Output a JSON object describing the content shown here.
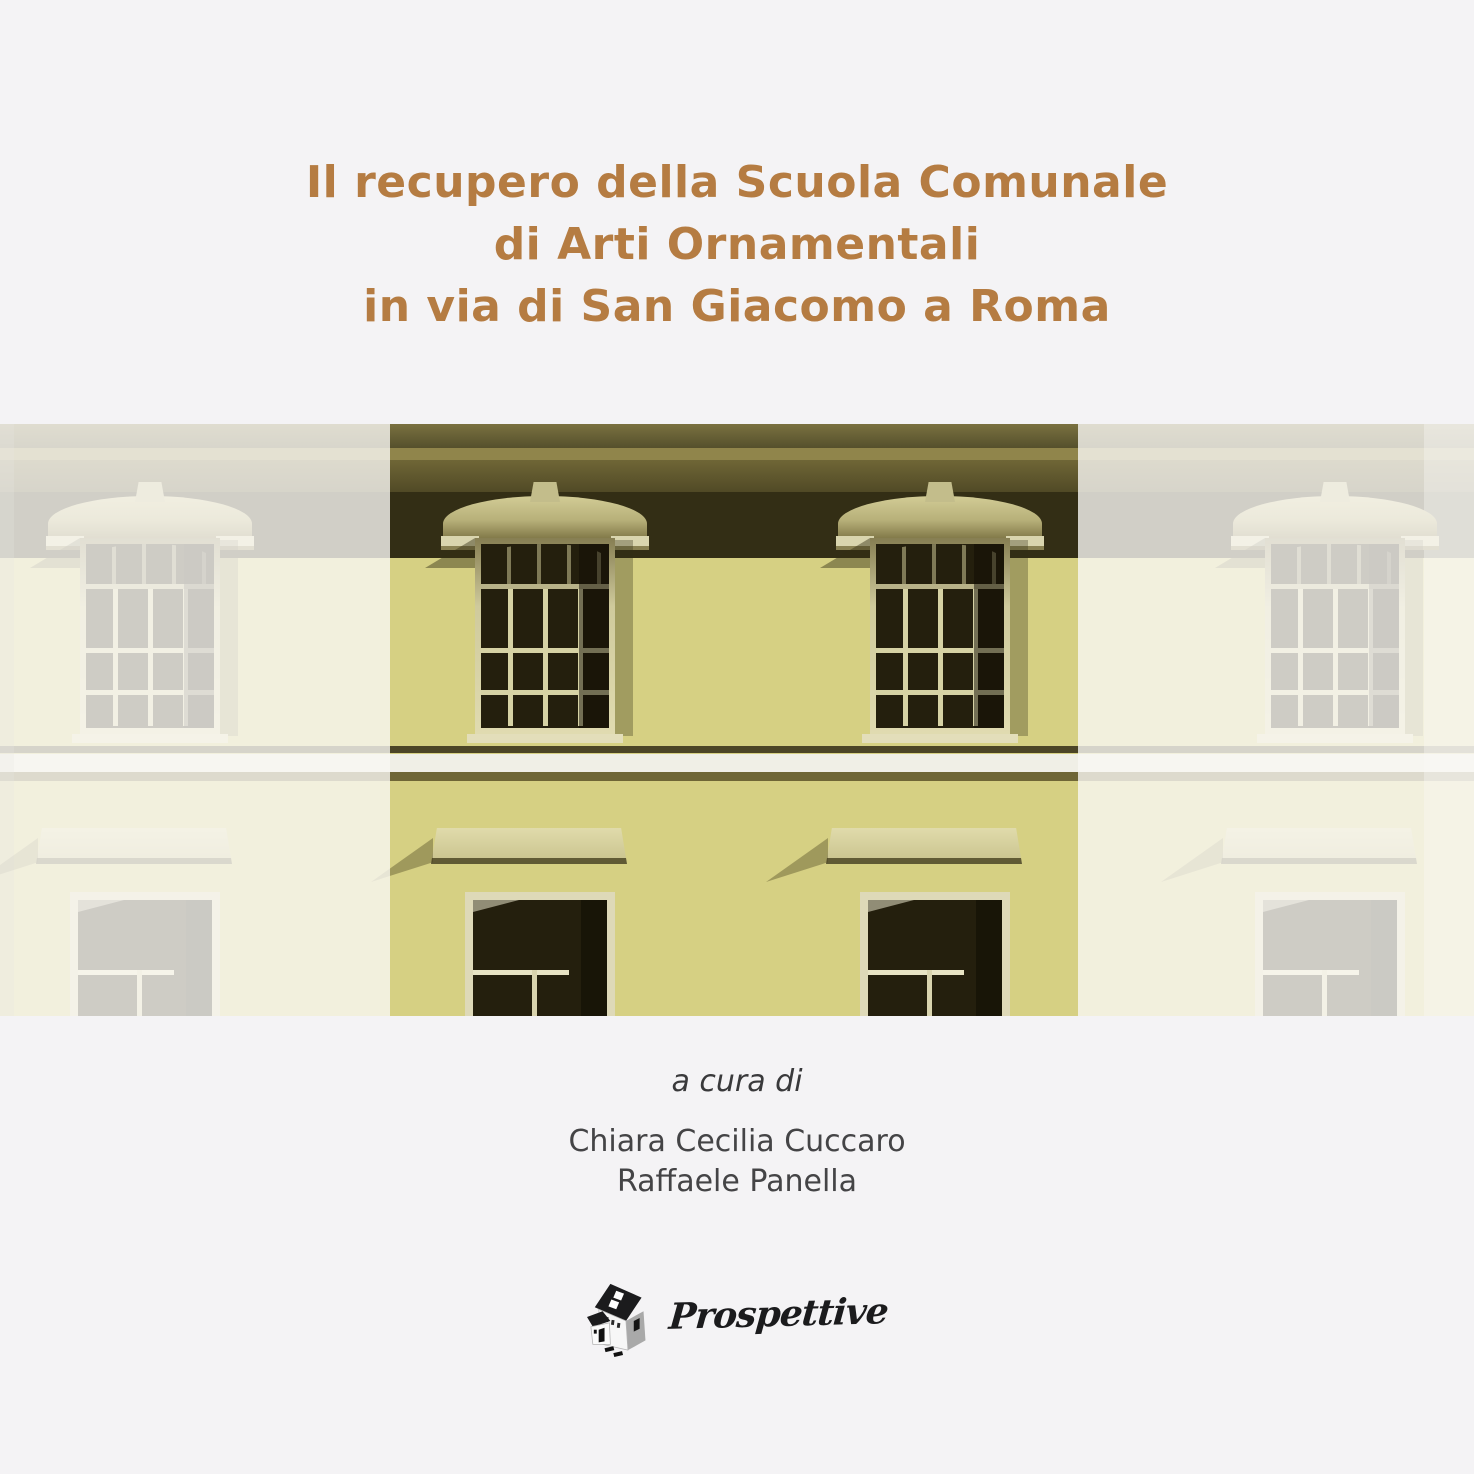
{
  "cover": {
    "title_lines": [
      "Il recupero della Scuola Comunale",
      "di Arti Ornamentali",
      "in via di San Giacomo a Roma"
    ],
    "curated_by_label": "a cura di",
    "editors": [
      "Chiara Cecilia Cuccaro",
      "Raffaele Panella"
    ],
    "publisher": {
      "name": "Prospettive",
      "logo_icon": "house-sketch-icon"
    }
  },
  "colors": {
    "title_ochre": "#b57c42",
    "cover_bg": "#f4f3f5",
    "facade_wall": "#d6d083",
    "facade_deep_shadow": "#332e15",
    "facade_cornice": "#6f6636",
    "window_dark": "#241f0d",
    "window_frame_light": "#e0dbb0",
    "string_course_white": "#f0efe6",
    "byline_gray": "#444446",
    "logo_ink": "#1b1b1d",
    "fade_overlay": "rgba(249,248,244,0.8)"
  }
}
